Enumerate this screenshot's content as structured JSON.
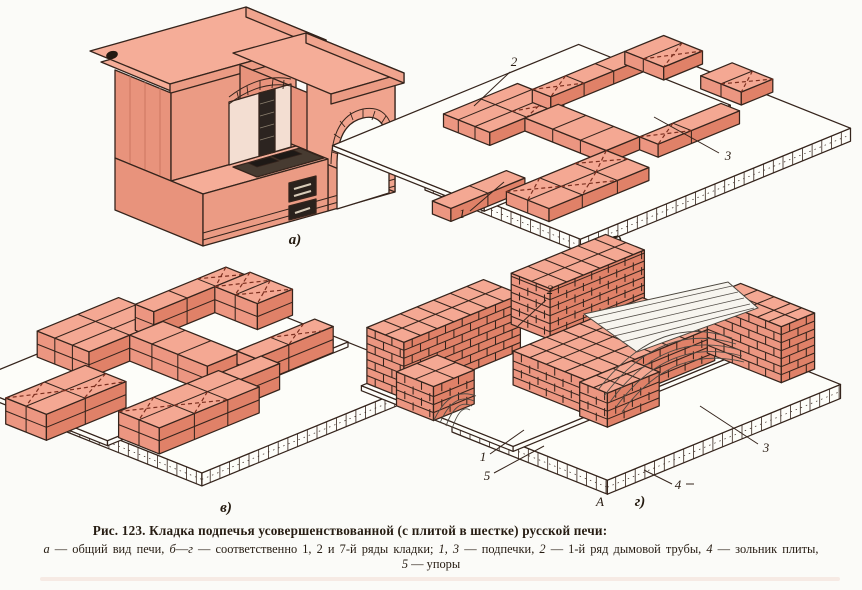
{
  "caption": {
    "line1": "Рис. 123. Кладка подпечья усовершенствованной (с плитой в шестке) русской печи:",
    "line2_segments": [
      {
        "t": "а",
        "i": 1
      },
      {
        "t": " — общий вид печи, "
      },
      {
        "t": "б",
        "i": 1
      },
      {
        "t": "—"
      },
      {
        "t": "г",
        "i": 1
      },
      {
        "t": " — соответственно 1, 2 и 7-й ряды кладки; "
      },
      {
        "t": "1, 3",
        "i": 1
      },
      {
        "t": " — подпечки, "
      },
      {
        "t": "2",
        "i": 1
      },
      {
        "t": " — 1-й ряд дымовой трубы, "
      },
      {
        "t": "4",
        "i": 1
      },
      {
        "t": " — зольник плиты,"
      }
    ],
    "line3_segments": [
      {
        "t": "5",
        "i": 1
      },
      {
        "t": " — упоры"
      }
    ]
  },
  "colors": {
    "line": "#35241c",
    "top": "#f4a893",
    "front": "#e08168",
    "side": "#ec9681",
    "slab": "#fdfdf9",
    "xmark": "#7c2f1f",
    "wood": "#4e4a42",
    "paper": "#fbfbf8",
    "dark": "#2a211c",
    "plate": "#473b31",
    "burner": "#1e1916",
    "slit": "#d8cbb8",
    "stovetop": "#f5ad98",
    "stovefront": "#eb9b84",
    "stoveside": "#f0a48e",
    "hatch": "#c4705a"
  },
  "drawings": [
    {
      "id": "fig-a",
      "label": "а)",
      "lx": 240,
      "ly": 240,
      "o": [
        60,
        206
      ],
      "a": [
        0.96,
        -0.27
      ],
      "b": [
        0.8,
        0.33
      ],
      "patches": [],
      "overlays": [],
      "callouts": []
    },
    {
      "id": "fig-b",
      "label": "б)",
      "lx": 218,
      "ly": 232,
      "o": [
        27,
        163
      ],
      "a": [
        0.925,
        -0.38
      ],
      "b": [
        0.925,
        0.37
      ],
      "patches": [
        {
          "r": [
            0,
            0,
            292,
            168
          ],
          "z": [
            -13,
            0
          ],
          "white": true,
          "blocks": true
        },
        {
          "r": [
            -14,
            -86,
            252,
            78
          ],
          "z": [
            0,
            5
          ],
          "white": true
        },
        {
          "r": [
            70,
            -50,
            150,
            0
          ],
          "z": [
            5,
            18
          ],
          "fj": true,
          "vj": [
            110
          ],
          "hj": [
            -34,
            -16
          ],
          "fx": [
            [
              110,
              -16,
              150,
              0
            ]
          ]
        },
        {
          "r": [
            150,
            -34,
            250,
            -14
          ],
          "z": [
            5,
            18
          ],
          "fj": true,
          "vj": [
            186,
            218
          ],
          "fx": [
            [
              150,
              -34,
              186,
              -14
            ]
          ]
        },
        {
          "r": [
            250,
            -34,
            292,
            8
          ],
          "z": [
            5,
            18
          ],
          "fj": true,
          "hj": [
            -14
          ],
          "fx": [
            [
              250,
              -14,
              292,
              8
            ]
          ]
        },
        {
          "r": [
            258,
            40,
            292,
            84
          ],
          "z": [
            5,
            18
          ],
          "fj": true,
          "hj": [
            62
          ],
          "fx": [
            [
              258,
              62,
              292,
              84
            ]
          ]
        },
        {
          "r": [
            108,
            0,
            144,
            88
          ],
          "z": [
            5,
            18
          ],
          "fj": true,
          "hj": [
            30,
            60
          ]
        },
        {
          "r": [
            144,
            88,
            232,
            108
          ],
          "z": [
            5,
            18
          ],
          "fj": true,
          "vj": [
            180
          ],
          "fx": [
            [
              144,
              88,
              180,
              108
            ]
          ]
        },
        {
          "r": [
            -52,
            60,
            28,
            80
          ],
          "z": [
            5,
            18
          ],
          "fj": true,
          "vj": [
            -12
          ]
        },
        {
          "r": [
            0,
            88,
            108,
            134
          ],
          "z": [
            5,
            18
          ],
          "fj": true,
          "vj": [
            36,
            74
          ],
          "hj": [
            111
          ],
          "fx": [
            [
              0,
              88,
              36,
              111
            ],
            [
              36,
              111,
              74,
              134
            ],
            [
              74,
              88,
              108,
              111
            ]
          ]
        }
      ],
      "overlays": [],
      "callouts": [
        {
          "text": "2",
          "x": 116,
          "y": 52,
          "l": [
            112,
            58,
            76,
            92
          ]
        },
        {
          "text": "3",
          "x": 330,
          "y": 146,
          "l": [
            321,
            139,
            256,
            103
          ]
        },
        {
          "text": "1",
          "x": 64,
          "y": 204,
          "l": [
            72,
            197,
            106,
            168
          ]
        }
      ]
    },
    {
      "id": "fig-v",
      "label": "в)",
      "lx": 208,
      "ly": 232,
      "o": [
        34,
        133
      ],
      "a": [
        0.925,
        -0.38
      ],
      "b": [
        0.925,
        0.37
      ],
      "patches": [
        {
          "r": [
            0,
            0,
            252,
            162
          ],
          "z": [
            -13,
            0
          ],
          "white": true,
          "blocks": true
        },
        {
          "r": [
            -14,
            -80,
            246,
            74
          ],
          "z": [
            0,
            5
          ],
          "white": true
        },
        {
          "r": [
            60,
            -76,
            148,
            -20
          ],
          "z": [
            5,
            31
          ],
          "fj": true,
          "mid": true,
          "vj": [
            104
          ],
          "hj": [
            -57,
            -38
          ]
        },
        {
          "r": [
            148,
            -58,
            246,
            -38
          ],
          "z": [
            5,
            31
          ],
          "fj": true,
          "mid": true,
          "vj": [
            184,
            215
          ],
          "fx": [
            [
              215,
              -58,
              246,
              -38
            ]
          ]
        },
        {
          "r": [
            214,
            -38,
            252,
            8
          ],
          "z": [
            5,
            31
          ],
          "fj": true,
          "mid": true,
          "hj": [
            -16
          ],
          "fx": [
            [
              214,
              -38,
              252,
              -16
            ],
            [
              214,
              -16,
              252,
              8
            ]
          ]
        },
        {
          "r": [
            104,
            -20,
            140,
            64
          ],
          "z": [
            5,
            31
          ],
          "fj": true,
          "mid": true,
          "hj": [
            4,
            32
          ]
        },
        {
          "r": [
            -46,
            -4,
            40,
            40
          ],
          "z": [
            5,
            31
          ],
          "fj": true,
          "mid": true,
          "vj": [
            -4
          ],
          "hj": [
            18
          ],
          "fx": [
            [
              -46,
              -4,
              -6,
              18
            ],
            [
              -6,
              18,
              40,
              40
            ]
          ]
        },
        {
          "r": [
            140,
            60,
            224,
            80
          ],
          "z": [
            5,
            31
          ],
          "fj": true,
          "mid": true,
          "vj": [
            176
          ],
          "fx": [
            [
              176,
              60,
              212,
              80
            ]
          ]
        },
        {
          "r": [
            104,
            80,
            146,
            100
          ],
          "z": [
            5,
            31
          ],
          "fj": true,
          "mid": true
        },
        {
          "r": [
            -4,
            76,
            104,
            120
          ],
          "z": [
            5,
            31
          ],
          "fj": true,
          "mid": true,
          "vj": [
            34,
            70
          ],
          "hj": [
            98
          ],
          "fx": [
            [
              -4,
              76,
              34,
              98
            ],
            [
              34,
              98,
              70,
              120
            ]
          ]
        }
      ],
      "overlays": [],
      "callouts": []
    },
    {
      "id": "fig-g",
      "label": "г)",
      "lx": 208,
      "ly": 262,
      "o": [
        20,
        174
      ],
      "a": [
        0.925,
        -0.38
      ],
      "b": [
        0.925,
        0.37
      ],
      "patches": [
        {
          "r": [
            0,
            0,
            252,
            168
          ],
          "z": [
            -14,
            0
          ],
          "white": true,
          "blocks": true
        },
        {
          "r": [
            -12,
            -86,
            246,
            78
          ],
          "z": [
            0,
            5
          ],
          "white": true
        },
        {
          "r": [
            -6,
            -86,
            120,
            -46
          ],
          "z": [
            5,
            61
          ],
          "courses": true,
          "vj": [
            12,
            30,
            48,
            66,
            84,
            102
          ],
          "hj": [
            -66
          ]
        },
        {
          "r": [
            150,
            -86,
            252,
            -44
          ],
          "z": [
            5,
            56
          ],
          "courses": true,
          "vj": [
            168,
            186,
            204,
            222,
            240
          ],
          "hj": [
            -64
          ]
        },
        {
          "r": [
            -20,
            -40,
            24,
            0
          ],
          "z": [
            5,
            39
          ],
          "courses": true,
          "vj": [
            2
          ],
          "hj": [
            -20
          ]
        },
        {
          "r": [
            70,
            -4,
            210,
            74
          ],
          "z": [
            5,
            39
          ],
          "courses": true,
          "vj": [
            88,
            106,
            124,
            142,
            160,
            178,
            196
          ],
          "hj": [
            14,
            32,
            52
          ]
        },
        {
          "r": [
            64,
            74,
            120,
            104
          ],
          "z": [
            5,
            39
          ],
          "courses": true,
          "vj": [
            82,
            100
          ],
          "hj": [
            89
          ]
        },
        {
          "r": [
            216,
            60,
            252,
            140
          ],
          "z": [
            5,
            61
          ],
          "courses": true,
          "vj": [
            234
          ],
          "hj": [
            78,
            96,
            114,
            126
          ]
        }
      ],
      "overlays": [
        {
          "tag": "polygon",
          "name": "formwork-deck",
          "at": {
            "points": "152,70 296,38 326,64 205,108",
            "fill": "#f7f5ef",
            "stroke": "#4b463e",
            "stroke-width": "1"
          }
        },
        {
          "tag": "path",
          "name": "formwork-deck-hatch",
          "at": {
            "d": "M158,74 L300,42 M166,80 L306,48 M174,86 L312,54 M182,92 L318,60 M190,98 L322,64",
            "stroke": "#55504a",
            "stroke-width": "0.8",
            "fill": "none"
          }
        },
        {
          "tag": "path",
          "name": "formwork-arch-big",
          "at": {
            "d": "M166,146 Q226,68 300,94 M172,152 Q229,76 304,100 M178,158 Q232,84 308,106 M184,163 Q236,92 310,112 M190,168 Q240,100 312,118",
            "stroke": "#4e4a44",
            "stroke-width": "0.9",
            "fill": "none"
          }
        },
        {
          "tag": "path",
          "name": "formwork-arch-small",
          "at": {
            "d": "M2,176 Q18,142 44,152 M8,179 Q21,148 42,157 M14,182 Q24,154 40,162 M20,185 Q28,160 38,166",
            "stroke": "#4e4a44",
            "stroke-width": "0.9",
            "fill": "none"
          }
        },
        {
          "tag": "line",
          "name": "dash-after-4",
          "at": {
            "x1": "254",
            "y1": "240",
            "x2": "262",
            "y2": "240",
            "stroke": "#35241c",
            "stroke-width": "1"
          }
        }
      ],
      "callouts": [
        {
          "text": "2",
          "x": 118,
          "y": 50,
          "l": [
            114,
            56,
            86,
            82
          ]
        },
        {
          "text": "3",
          "x": 334,
          "y": 208,
          "l": [
            326,
            200,
            268,
            162
          ]
        },
        {
          "text": "1",
          "x": 51,
          "y": 217,
          "l": [
            58,
            210,
            92,
            186
          ]
        },
        {
          "text": "5",
          "x": 55,
          "y": 236,
          "l": [
            62,
            229,
            112,
            202
          ]
        },
        {
          "text": "4",
          "x": 246,
          "y": 245,
          "l": [
            240,
            240,
            212,
            226
          ]
        },
        {
          "text": "А",
          "x": 168,
          "y": 262
        }
      ]
    }
  ]
}
